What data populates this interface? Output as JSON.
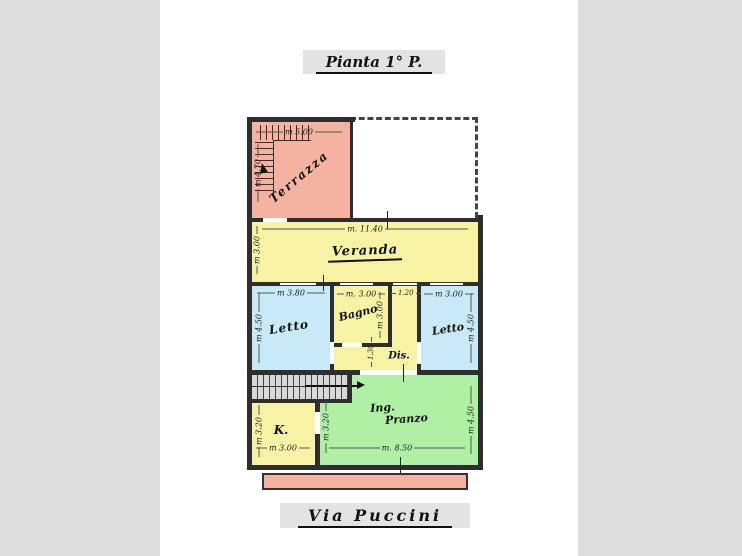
{
  "meta": {
    "plan_title": "Pianta 1° P.",
    "street_label": "Via Puccini"
  },
  "colors": {
    "background": "#dcdcdc",
    "paper": "#ffffff",
    "terrace_pink": "#f4b2a0",
    "room_yellow": "#f8f3a4",
    "room_blue": "#c8e9f5",
    "room_green": "#b0f0a4",
    "wall": "#2e2e2e",
    "caption_box": "#e3e3e3",
    "stair_gray": "#d8d8d8"
  },
  "rooms": {
    "terrazza": {
      "label": "Terrazza",
      "dim_top": "m 5.00",
      "dim_left": "m 4.70"
    },
    "veranda": {
      "label": "Veranda",
      "dim_top": "m. 11.40",
      "dim_left": "m 3.00"
    },
    "letto_sx": {
      "label": "Letto",
      "dim_top": "m 3.80",
      "dim_left": "m 4.50"
    },
    "bagno": {
      "label": "Bagno",
      "dim_top": "m. 3.00",
      "dim_right": "m 3.00"
    },
    "corridoio": {
      "dim_top": "1.20"
    },
    "letto_dx": {
      "label": "Letto",
      "dim_top": "m 3.00",
      "dim_right": "m 4.50"
    },
    "dis": {
      "label": "Dis.",
      "dim_left": "1.30"
    },
    "cucina": {
      "label": "K.",
      "dim_left": "m 3.20",
      "dim_bottom": "m 3.00"
    },
    "ingresso_pranzo": {
      "label_line1": "Ing.",
      "label_line2": "Pranzo",
      "dim_left": "m 3.20",
      "dim_bottom": "m. 8.50",
      "dim_right": "m 4.50"
    }
  }
}
